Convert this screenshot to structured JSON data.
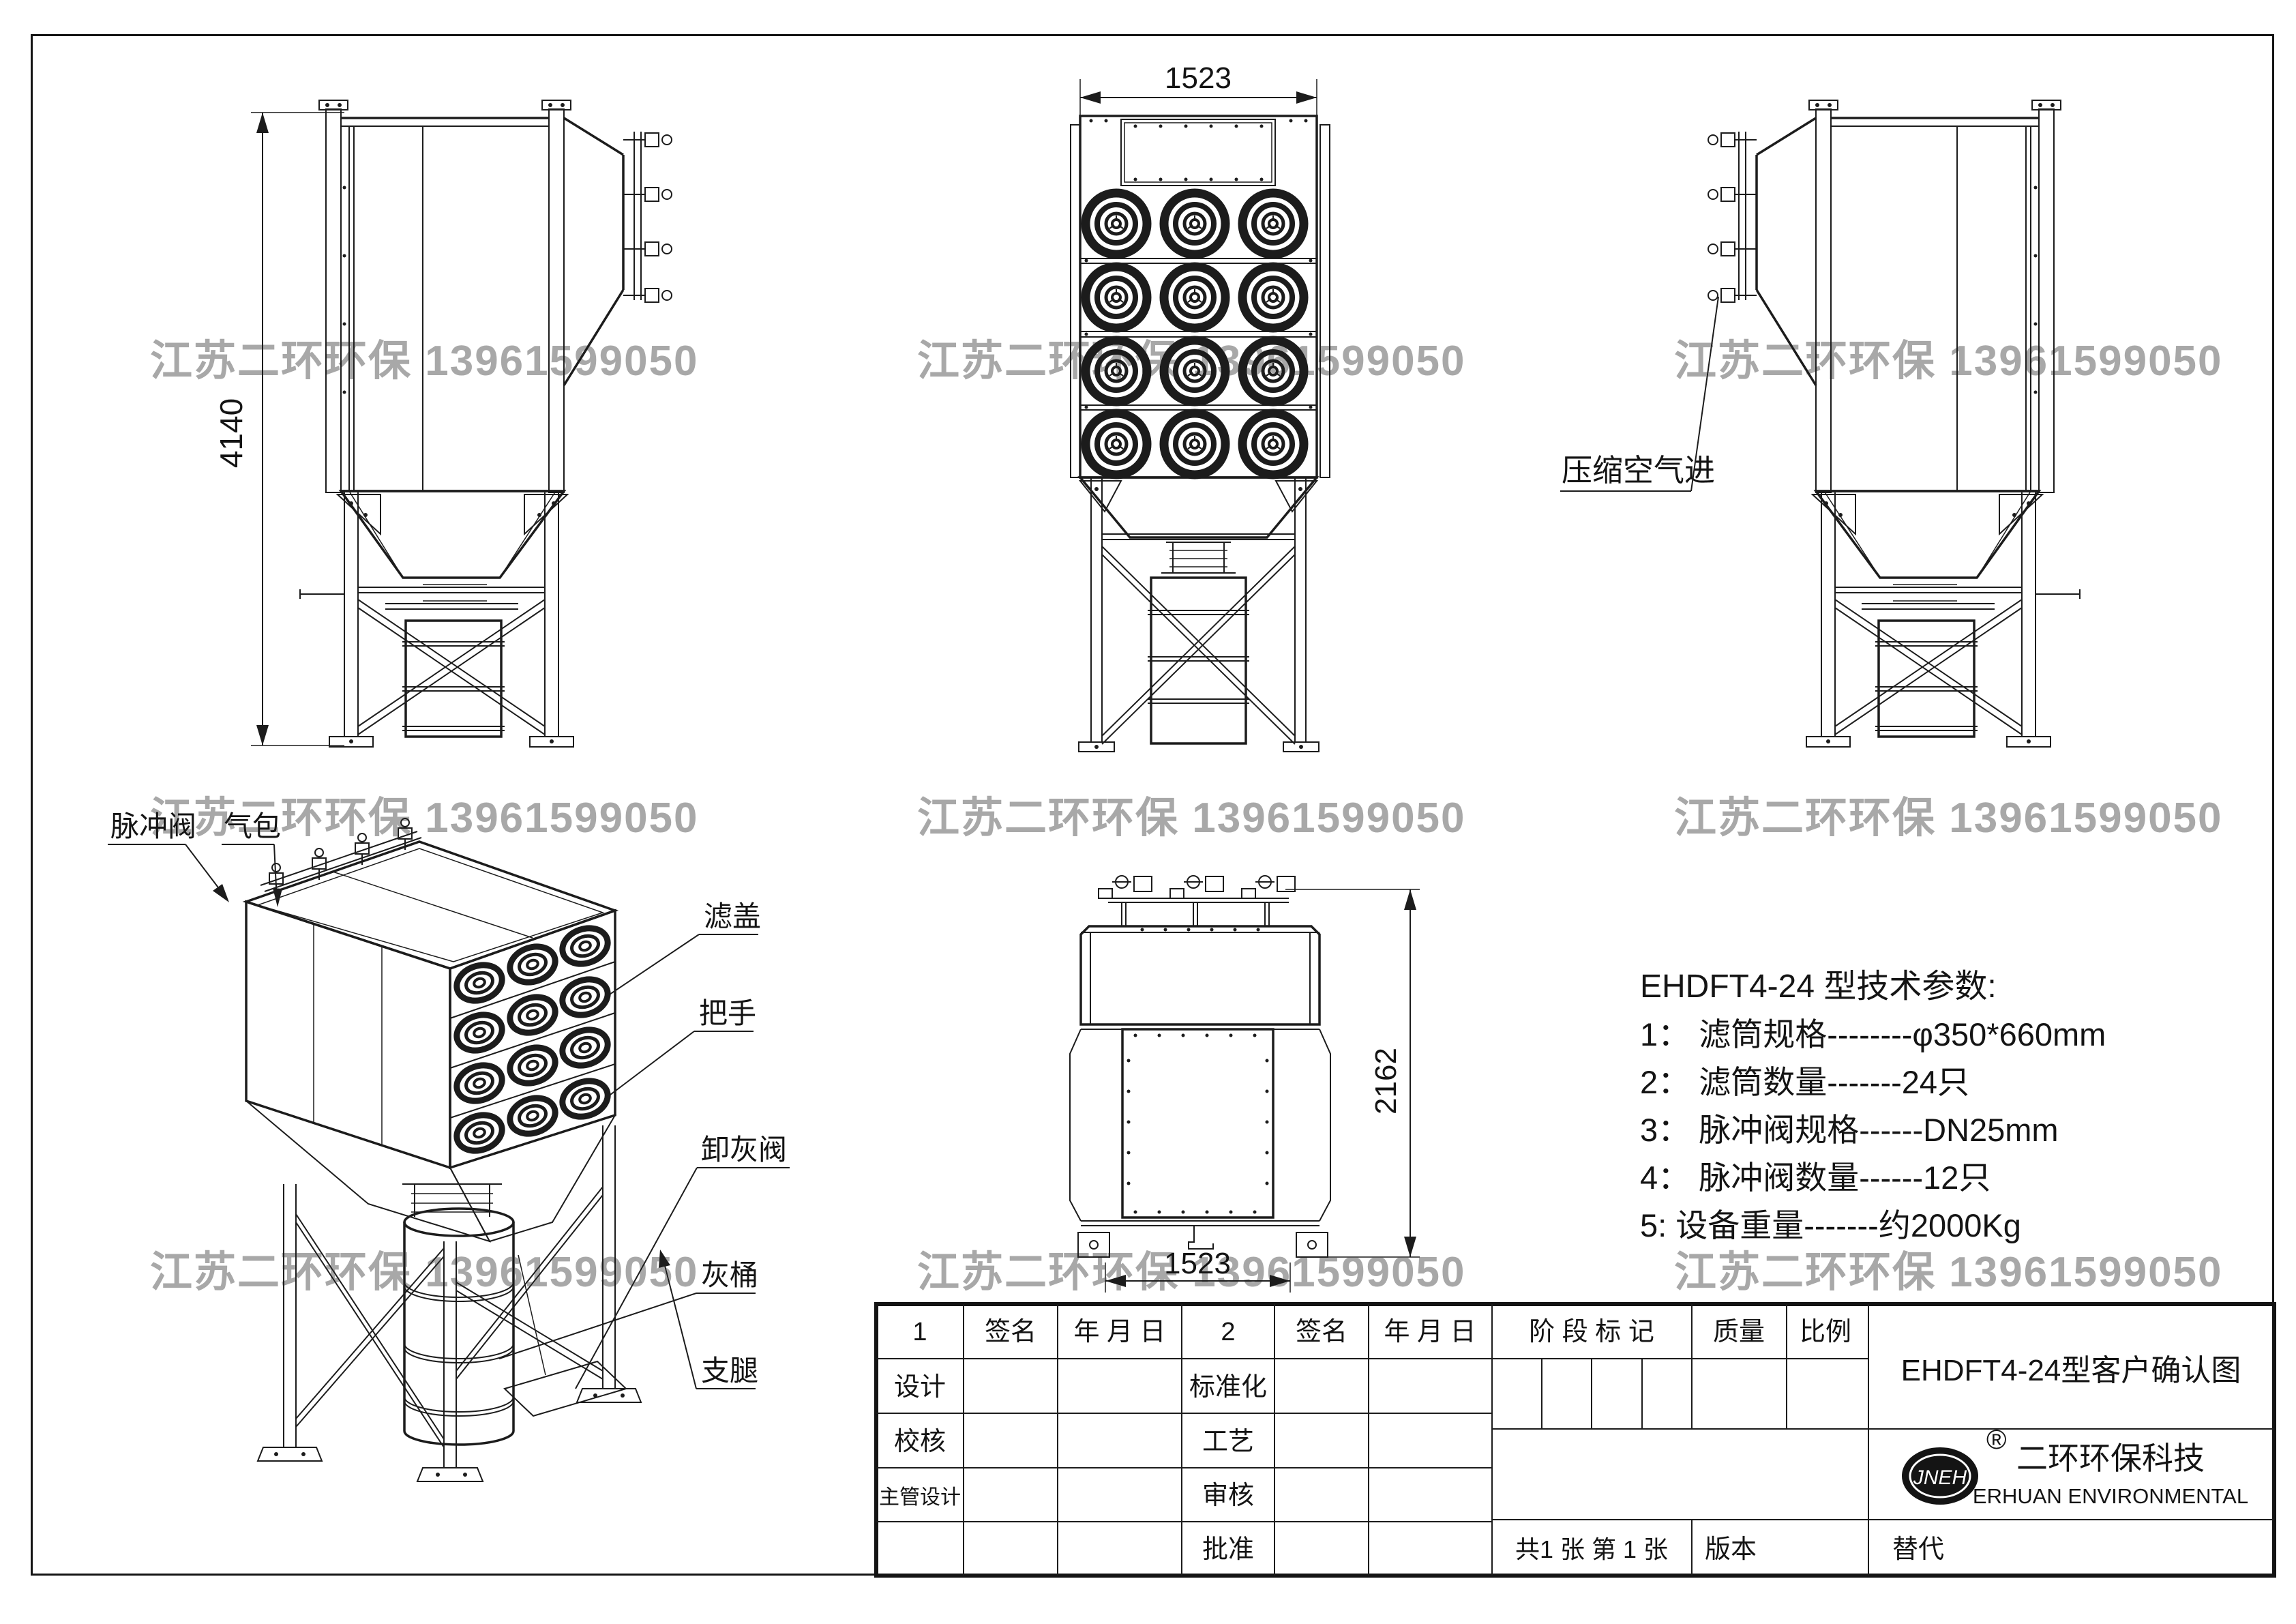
{
  "watermark": {
    "text": "江苏二环环保 13961599050",
    "color": "#a8a8a8"
  },
  "dims": {
    "side_height": "4140",
    "front_width": "1523",
    "top_height": "2162",
    "top_width": "1523"
  },
  "labels": {
    "air_inlet": "压缩空气进",
    "pulse_valve": "脉冲阀",
    "air_bag": "气包",
    "filter_cover": "滤盖",
    "handle": "把手",
    "ash_valve": "卸灰阀",
    "ash_bucket": "灰桶",
    "leg": "支腿"
  },
  "tech": {
    "title": "EHDFT4-24 型技术参数:",
    "item1": "1： 滤筒规格--------φ350*660mm",
    "item2": "2： 滤筒数量-------24只",
    "item3": "3： 脉冲阀规格------DN25mm",
    "item4": "4： 脉冲阀数量------12只",
    "item5": "5:  设备重量-------约2000Kg"
  },
  "tb": {
    "c1": "1",
    "sign": "签名",
    "date": "年 月 日",
    "c2": "2",
    "design": "设计",
    "standard": "标准化",
    "check": "校核",
    "craft": "工艺",
    "chief": "主管设计",
    "review": "审核",
    "approve": "批准",
    "stage": "阶 段 标 记",
    "mass": "质量",
    "scale": "比例",
    "doc_title": "EHDFT4-24型客户确认图",
    "logo": "JNEH",
    "reg": "®",
    "company_cn": "二环环保科技",
    "company_en": "ERHUAN ENVIRONMENTAL",
    "sheets": "共1 张   第 1 张",
    "version": "版本",
    "replace": "替代"
  }
}
